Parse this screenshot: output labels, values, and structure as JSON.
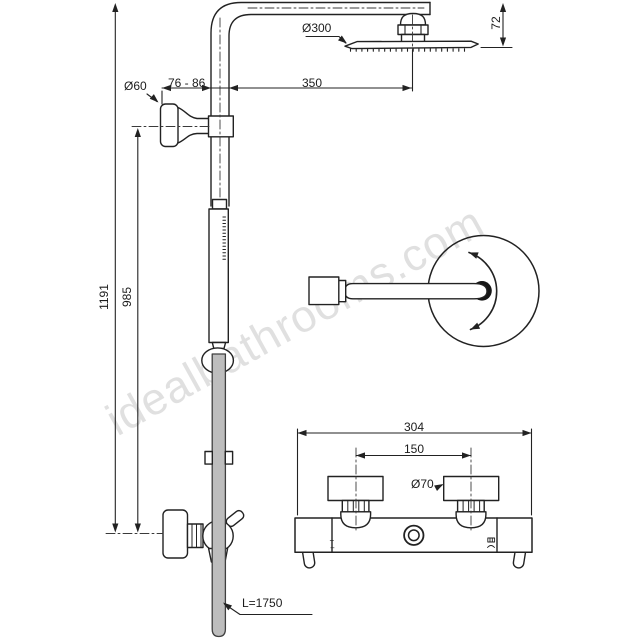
{
  "drawing": {
    "kind": "technical-line-drawing",
    "subject": "thermostatic-shower-system"
  },
  "watermark": {
    "text": "idealbathrooms.com"
  },
  "labels": {
    "head_diameter": "Ø300",
    "head_offset_height": "72",
    "wall_clearance": "76 - 86",
    "arm_projection": "350",
    "flange_diameter": "Ø60",
    "riser_height_total": "1191",
    "riser_height_lower": "985",
    "hose_length": "L=1750",
    "mixer_width": "304",
    "inlet_centres": "150",
    "inlet_flange_diameter": "Ø70",
    "mixer_marking_plus": "+",
    "mixer_marking_minus": "−"
  },
  "colors": {
    "line": "#222222",
    "hose_fill": "#bdbdbd",
    "background": "#ffffff",
    "watermark": "rgba(0,0,0,0.12)"
  }
}
